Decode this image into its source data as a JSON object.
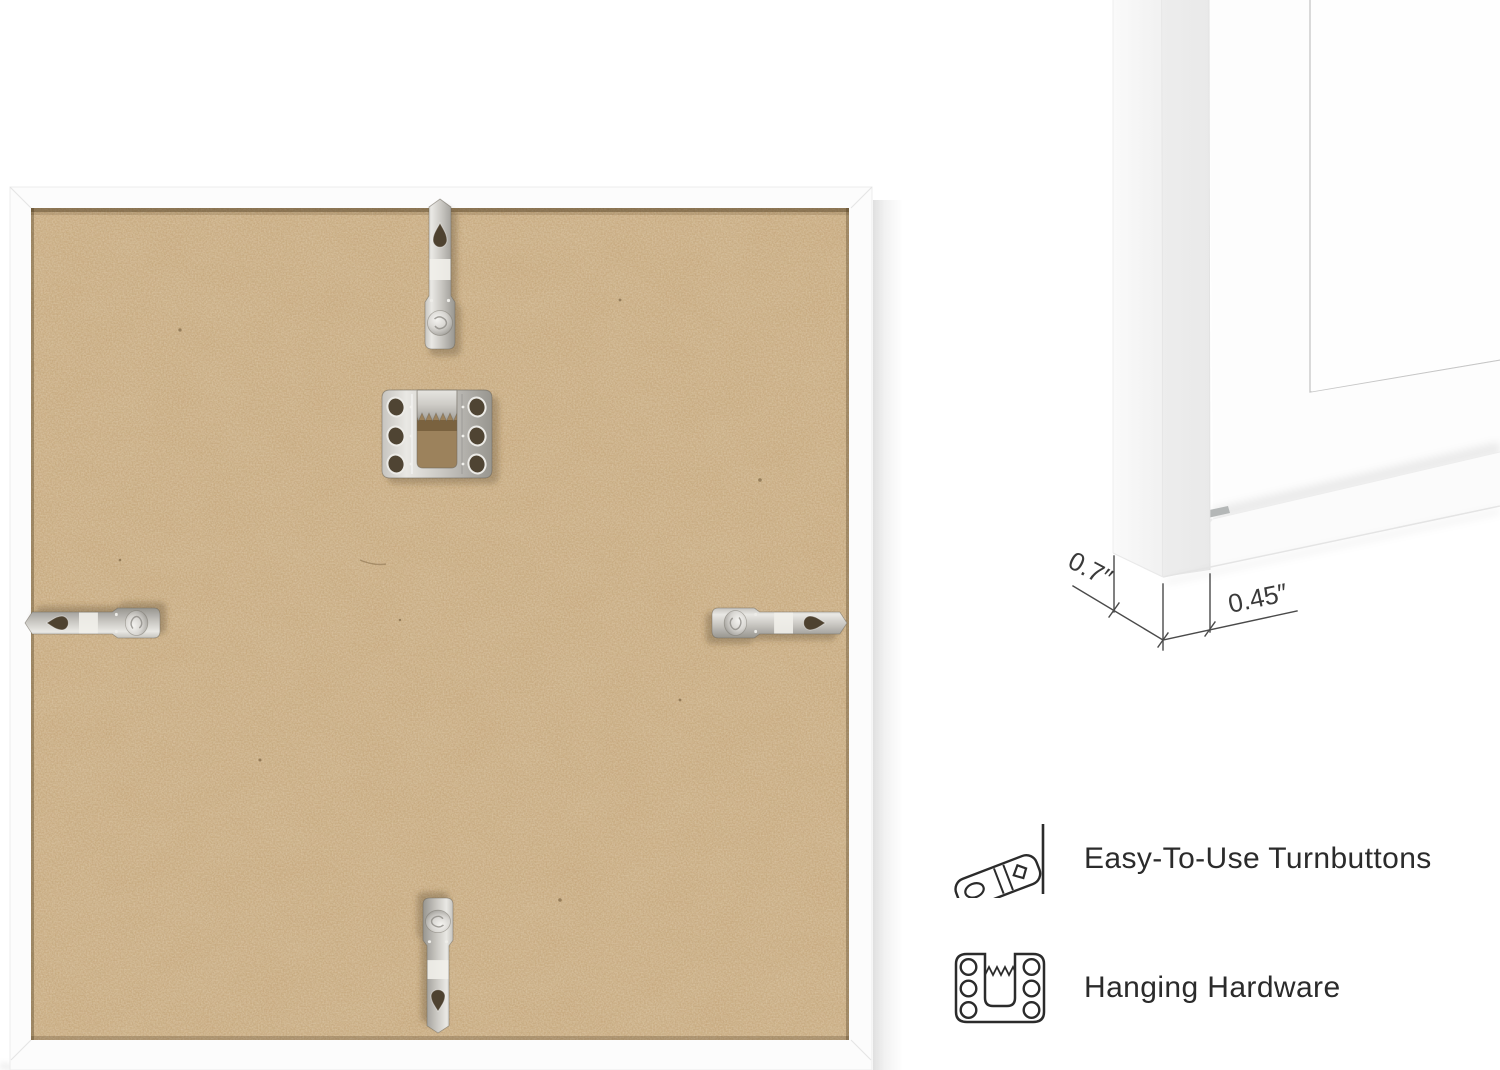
{
  "corner_detail": {
    "depth_label": "0.7″",
    "face_label": "0.45″"
  },
  "features": [
    {
      "icon": "turnbutton-icon",
      "label": "Easy-To-Use Turnbuttons"
    },
    {
      "icon": "sawtooth-hanger-icon",
      "label": "Hanging Hardware"
    }
  ],
  "photo": {
    "subject": "frame-back-with-hardware",
    "hardware": [
      "top-turnbutton",
      "sawtooth-hanger",
      "left-turnbutton",
      "right-turnbutton",
      "bottom-turnbutton"
    ]
  },
  "colors": {
    "background": "#ffffff",
    "frame_white": "#fcfcfc",
    "mdf_base": "#c7a87d",
    "metal": "#c9c7c2",
    "feature_text": "#2b2b2b",
    "dimension_line": "#4a4a4a"
  }
}
